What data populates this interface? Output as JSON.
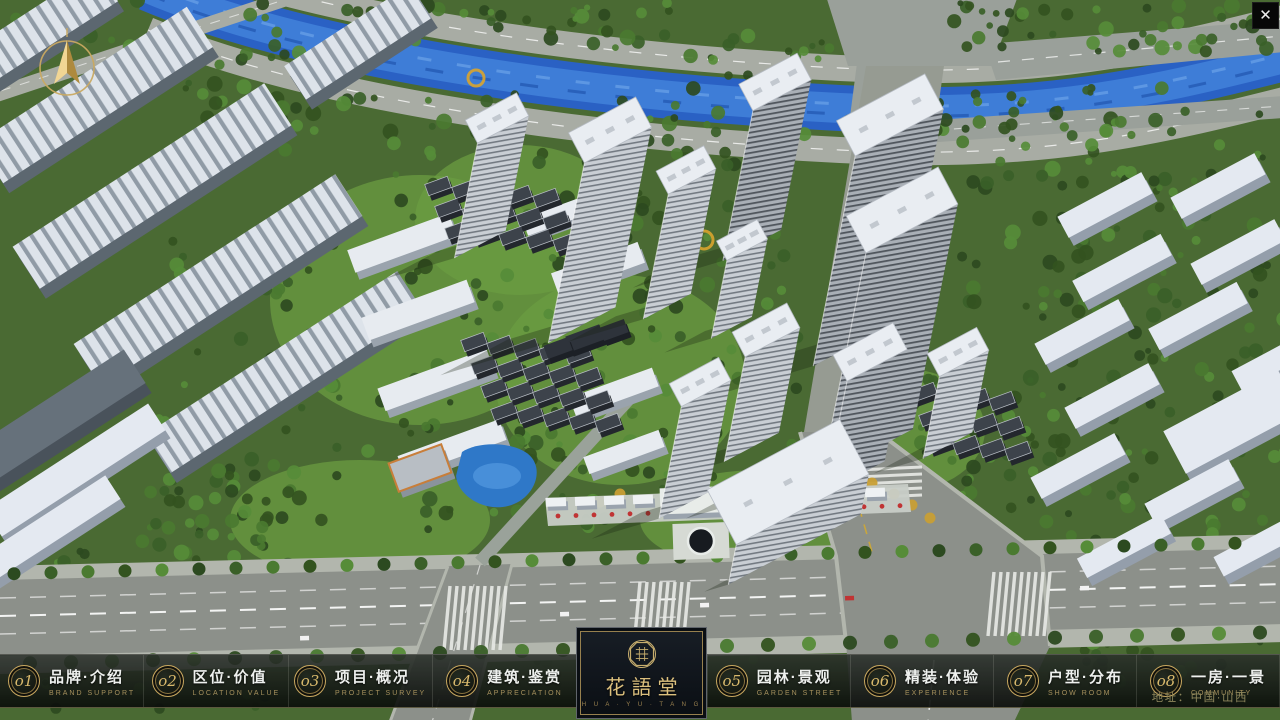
{
  "window": {
    "close_icon": "✕"
  },
  "logo": {
    "title": "花語堂",
    "subtitle": "H U A · Y U · T A N G"
  },
  "menu": {
    "items": [
      {
        "num": "o1",
        "title": "品牌·介绍",
        "subtitle": "BRAND SUPPORT"
      },
      {
        "num": "o2",
        "title": "区位·价值",
        "subtitle": "LOCATION VALUE"
      },
      {
        "num": "o3",
        "title": "项目·概况",
        "subtitle": "PROJECT SURVEY"
      },
      {
        "num": "o4",
        "title": "建筑·鉴赏",
        "subtitle": "APPRECIATION"
      },
      {
        "num": "o5",
        "title": "园林·景观",
        "subtitle": "GARDEN STREET"
      },
      {
        "num": "o6",
        "title": "精装·体验",
        "subtitle": "EXPERIENCE"
      },
      {
        "num": "o7",
        "title": "户型·分布",
        "subtitle": "SHOW ROOM"
      },
      {
        "num": "o8",
        "title": "一房·一景",
        "subtitle": "COMMUNITY"
      }
    ]
  },
  "footer": {
    "address": "地址：中国·山西"
  },
  "colors": {
    "accent_gold": "#c8a75f",
    "bar_background": "#0c100c",
    "title_text": "#eef0ee",
    "subtitle_text": "#a6915d",
    "address_text": "#8d865c",
    "river_blue": "#2a61c4",
    "tree_green": "#3a6028"
  }
}
